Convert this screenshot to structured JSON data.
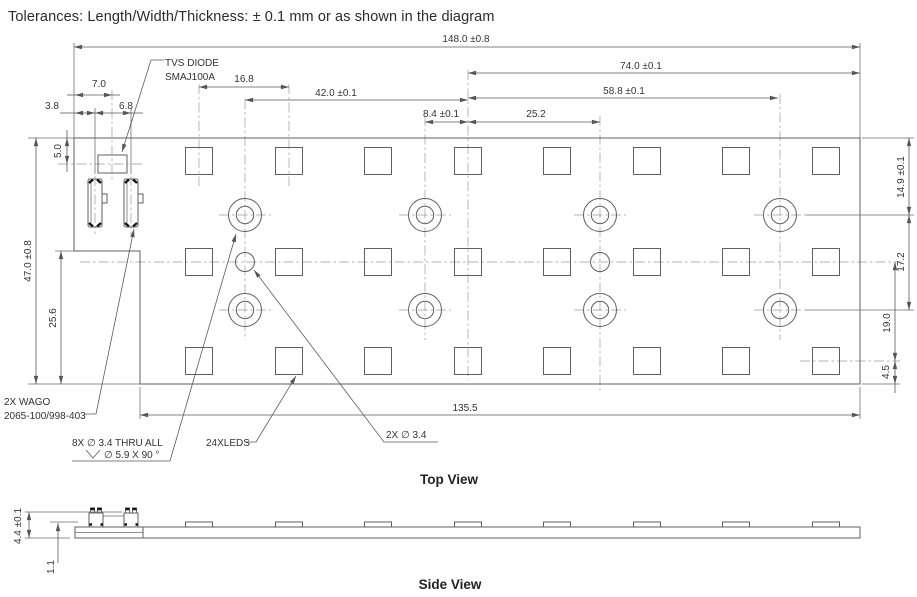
{
  "title": "Tolerances: Length/Width/Thickness: ± 0.1 mm or as shown in the diagram",
  "top_view": {
    "label": "Top View",
    "dims": {
      "w148": "148.0 ±0.8",
      "w74": "74.0 ±0.1",
      "w588": "58.8 ±0.1",
      "w42": "42.0 ±0.1",
      "w168": "16.8",
      "w84": "8.4 ±0.1",
      "w252": "25.2",
      "w1355": "135.5",
      "h47": "47.0 ±0.8",
      "h256": "25.6",
      "h50": "5.0",
      "h70": "7.0",
      "h38": "3.8",
      "h68": "6.8",
      "h149": "14.9 ±0.1",
      "h172": "17.2",
      "h190": "19.0",
      "h45": "4.5"
    },
    "callouts": {
      "tvs1": "TVS DIODE",
      "tvs2": "SMAJ100A",
      "wago1": "2X WAGO",
      "wago2": "2065-100/998-403",
      "holes1": "8X  ∅ 3.4 THRU ALL",
      "holes2": "∅ 5.9 X 90 °",
      "leds": "24XLEDS",
      "small_holes": "2X  ∅ 3.4"
    }
  },
  "side_view": {
    "label": "Side View",
    "dims": {
      "h44": "4.4 ±0.1",
      "h11": "1.1"
    }
  }
}
